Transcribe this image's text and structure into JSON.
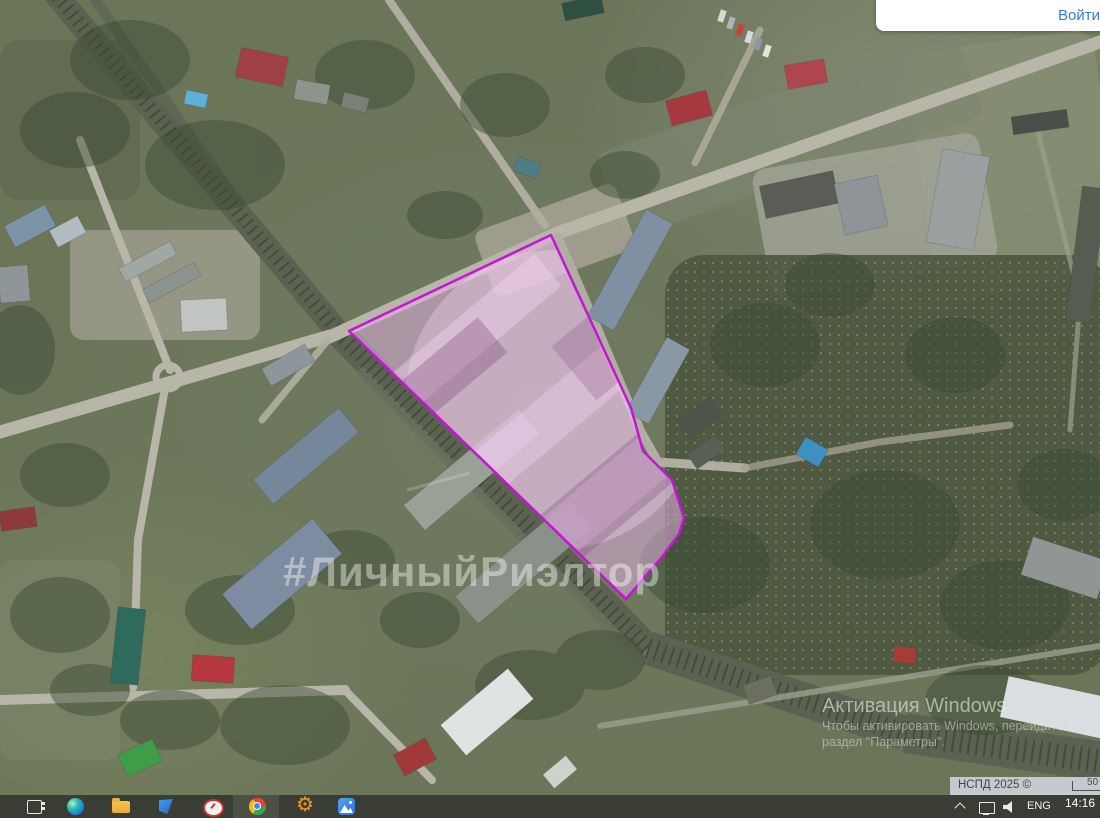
{
  "login_bar": {
    "label": "Войти"
  },
  "map": {
    "watermark": "#ЛичныйРиэлтор",
    "parcel": {
      "points": "551,235 631,408 643,451 672,480 684,518 679,534 662,557 626,599 349,331",
      "stroke": "#c414d6",
      "fill": "rgba(226,174,222,0.55)"
    },
    "attribution": {
      "text": "НСПД 2025 ©",
      "scale_label": "50"
    }
  },
  "activation_watermark": {
    "title": "Активация Windows",
    "line1": "Чтобы активировать Windows, перейдите в",
    "line2": "раздел \"Параметры\"."
  },
  "taskbar": {
    "icons": {
      "task_view": "outlined-rectangle-with-dots",
      "edge": "blue-green-swirl-circle",
      "file_explorer": "yellow-folder",
      "blue_app": "blue-folded-flag",
      "clock_app": "white-oval-red-clock",
      "chrome": "red-yellow-green-ring-blue-center",
      "settings_gear": "⚙",
      "photos": "blue-square-white-mountain"
    },
    "tray": {
      "expand": "chevron-up",
      "network": "monitor-outline",
      "volume": "speaker-waves",
      "language": "ENG",
      "time": "14:16"
    }
  }
}
